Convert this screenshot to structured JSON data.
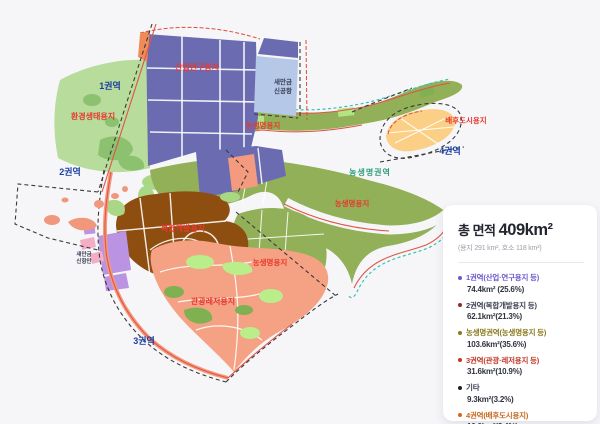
{
  "map": {
    "zone_labels": [
      "1권역",
      "2권역",
      "3권역",
      "4권역"
    ],
    "area_labels": {
      "industrial": "산업연구용지",
      "eco": "환경생태용지",
      "agri_top": "농생명용지",
      "agri_mid": "농생명용지",
      "agri_right": "농생명용지",
      "hinterland": "배후도시용지",
      "complex": "복합개발용지",
      "tourism": "관광레저용지",
      "agri_zone": "농생명권역"
    },
    "airport_label": {
      "line1": "새만금",
      "line2": "신공항"
    },
    "port_label": {
      "line1": "새만금",
      "line2": "신항만"
    }
  },
  "legend": {
    "title_prefix": "총 면적 ",
    "title_value": "409km²",
    "note": "(용지 291 km², 호소 118 km²)",
    "items": [
      {
        "label": "1권역(산업·연구용지 등)",
        "value": "74.4km² (25.6%)",
        "color": "#6a5acd",
        "text_color": "#6a5acd"
      },
      {
        "label": "2권역(복합개발용지 등)",
        "value": "62.1km²(21.3%)",
        "color": "#8b2e2e",
        "text_color": "#3a4055"
      },
      {
        "label": "농생명권역(농생명용지 등)",
        "value": "103.6km²(35.6%)",
        "color": "#8a7a1e",
        "text_color": "#8a7a1e"
      },
      {
        "label": "3권역(관광·레저용지 등)",
        "value": "31.6km²(10.9%)",
        "color": "#c0392b",
        "text_color": "#c0392b"
      },
      {
        "label": "기타",
        "value": "9.3km²(3.2%)",
        "color": "#222222",
        "text_color": "#3a4055"
      },
      {
        "label": "4권역(배후도시용지)",
        "value": "10.0km²(3.4%)",
        "color": "#d2691e",
        "text_color": "#c8681e"
      }
    ]
  },
  "colors": {
    "background": "#f6f6f9",
    "industrial_purple": "#6b6bb2",
    "airport_blue": "#b6c8e8",
    "eco_green": "#b7dc9b",
    "agri_olive": "#92b058",
    "hinterland_yellow": "#fbcf85",
    "complex_brown": "#8e4e10",
    "tourism_salmon": "#f5a284",
    "port_lavender": "#ba93e2",
    "port_pink": "#f3aec5",
    "bright_green": "#b9ee8b",
    "coast_teal_dash": "#35c4b5",
    "coast_red_line": "#e05545",
    "boundary_black_dash": "#3a3a3a",
    "label_red": "#e8392f",
    "label_navy": "#1b3fa0"
  }
}
